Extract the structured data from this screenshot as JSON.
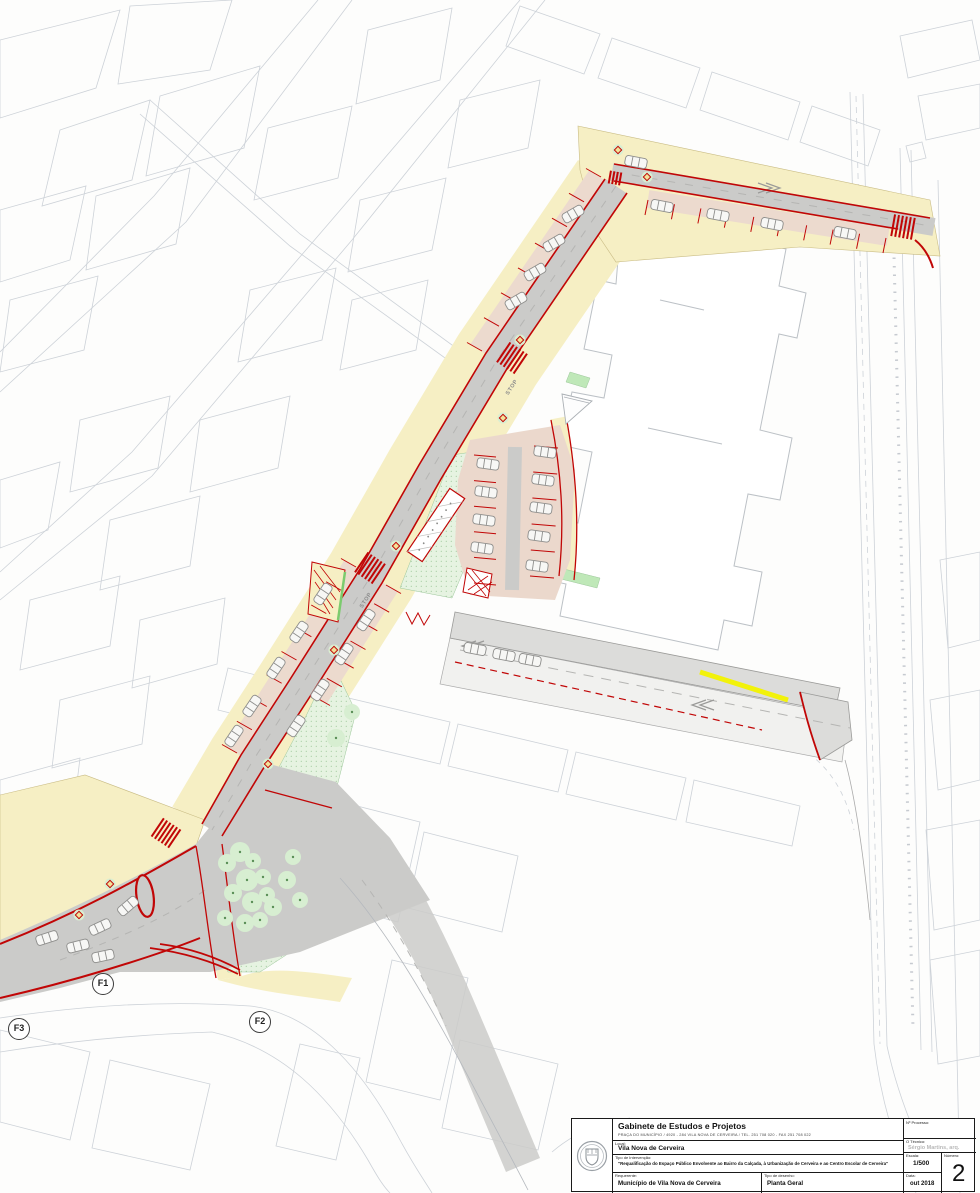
{
  "map": {
    "markers": [
      {
        "label": "F1",
        "x": 103,
        "y": 984
      },
      {
        "label": "F2",
        "x": 260,
        "y": 1022
      },
      {
        "label": "F3",
        "x": 19,
        "y": 1029
      }
    ],
    "road_labels": [
      {
        "text": "STOP",
        "x": 513,
        "y": 388,
        "rot": -57
      },
      {
        "text": "STOP",
        "x": 367,
        "y": 601,
        "rot": -57
      }
    ]
  },
  "title_block": {
    "office_name": "Gabinete de Estudos e Projetos",
    "office_address": "PRAÇA DO MUNICÍPIO  /  4920 - 284 VILA NOVA DE CERVEIRA  /  TEL. 251 708 020  -  FAX 251 708 022",
    "local_label": "Local:",
    "local_value": "Vila Nova de Cerveira",
    "intervention_label": "Tipo de Intervenção:",
    "intervention_value": "\"Requalificação do Espaço Público Envolvente ao Bairro da Calçada, à Urbanização de Cerveira e ao Centro Escolar de Cerveira\"",
    "requerente_label": "Requerente:",
    "requerente_value": "Município de Vila Nova de Cerveira",
    "drawing_type_label": "Tipo de desenho:",
    "drawing_type_value": "Planta Geral",
    "processo_label": "Nº Processo:",
    "tecnico_label": "O Técnico:",
    "tecnico_value": "Sérgio Martins, arq.",
    "escala_label": "Escala:",
    "escala_value": "1/500",
    "data_label": "Data:",
    "data_value": "out 2018",
    "numero_label": "Número:",
    "numero_value": "2"
  },
  "colors": {
    "sidewalk_yellow": "#F6EFC4",
    "road_gray": "#CBCBC9",
    "parking_pink": "#ECDACE",
    "green_area": "#E6F3E1",
    "curb_red": "#C10606",
    "highlight_yellow": "#F2F20A"
  }
}
